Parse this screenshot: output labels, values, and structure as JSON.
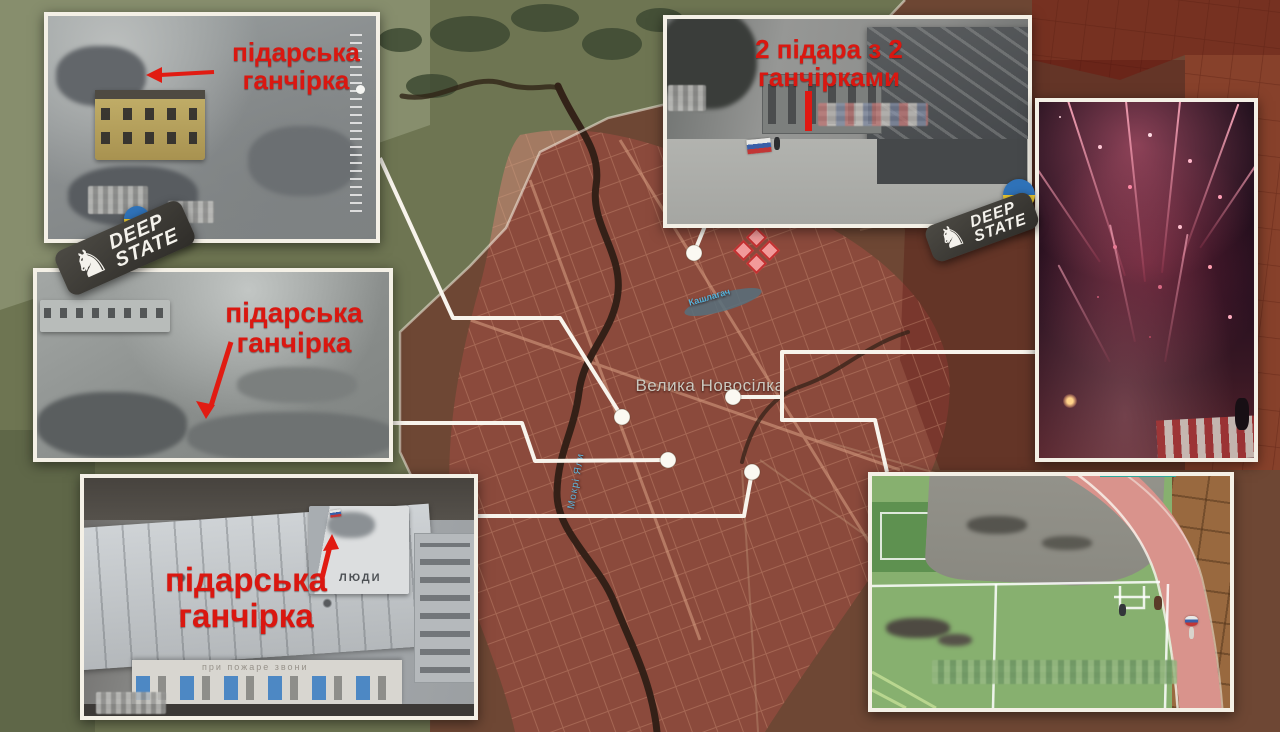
{
  "annotations": {
    "top_left": {
      "line1": "підарська",
      "line2": "ганчірка"
    },
    "middle_left": {
      "line1": "підарська",
      "line2": "ганчірка"
    },
    "bottom_left": {
      "line1": "підарська",
      "line2": "ганчірка"
    },
    "top_middle": {
      "line1": "2 підара з 2",
      "line2": "ганчірками"
    }
  },
  "map": {
    "town_label": "Велика Новосілка",
    "river_label": "Мокрі Яли",
    "pond_label": "Кашлагач"
  },
  "badges": {
    "line1": "DEEP",
    "line2": "STATE",
    "knight": "♞"
  },
  "photos": {
    "bottom_left": {
      "roof_text": "ЛЮДИ",
      "facade_text": "при пожаре звони"
    }
  },
  "colors": {
    "annotation_red": "#da1710",
    "connector_white": "#f8f4ec",
    "occupied_overlay": "#7a1414",
    "track_pink": "#d9938c",
    "field_green": "#87b06f",
    "accent_teal": "#2aa99c"
  }
}
